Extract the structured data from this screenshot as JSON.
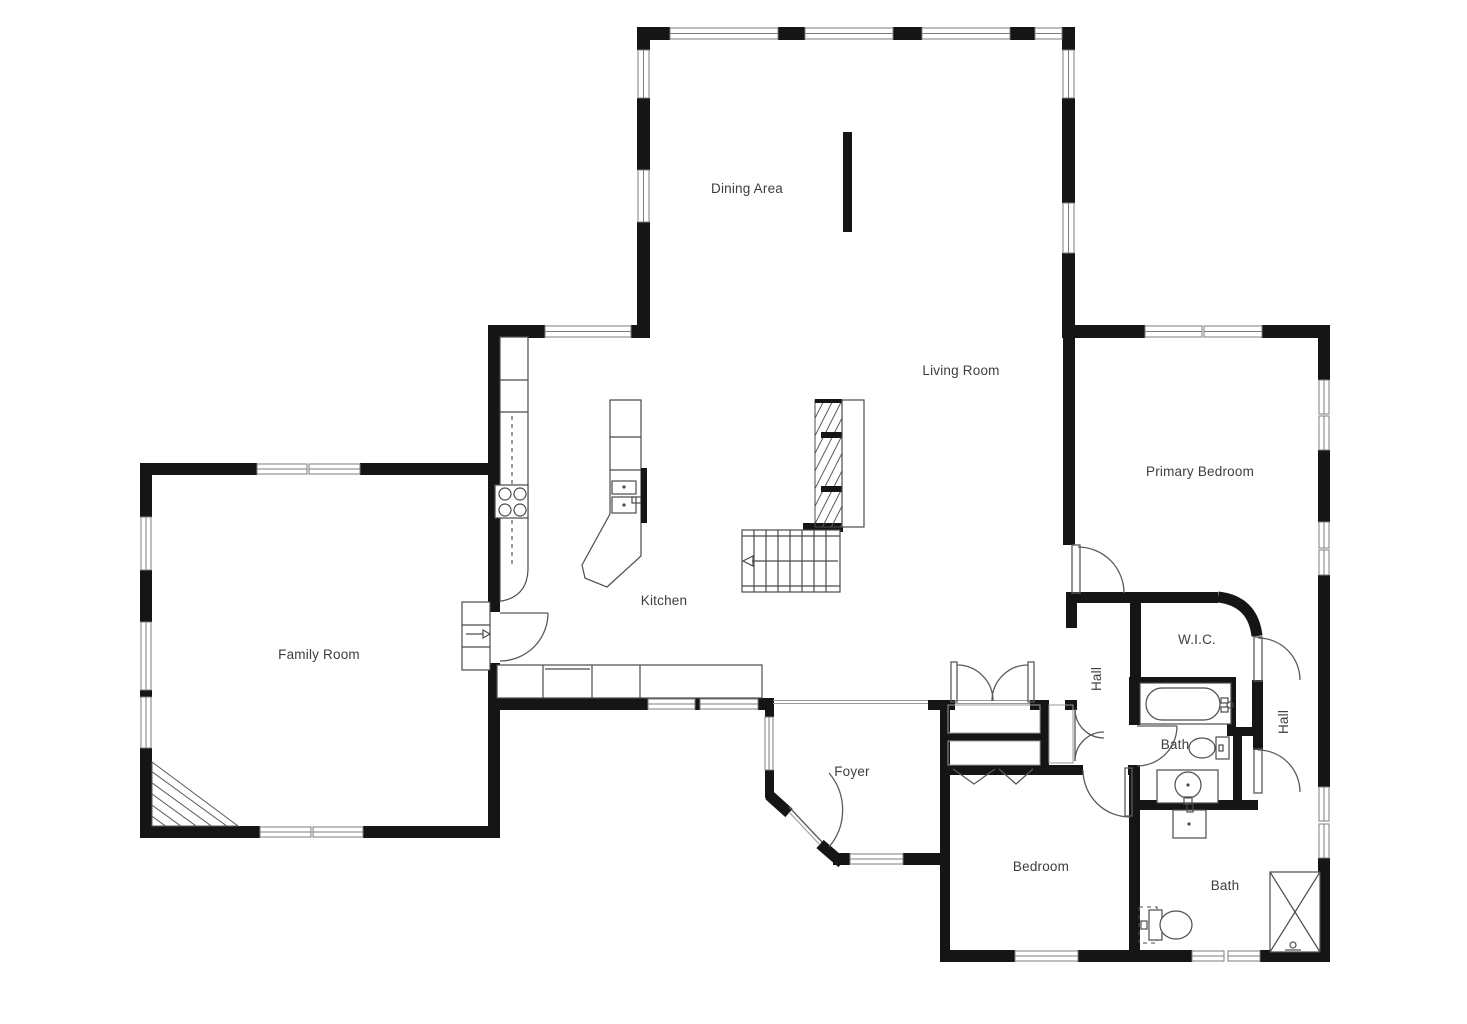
{
  "title": "Residential floor plan",
  "colors": {
    "background": "#ffffff",
    "walls": "#151515",
    "fixture_lines": "#4b4b4b",
    "window_frame": "#7d7d7d",
    "label_text": "#3d3d3d"
  },
  "rooms": {
    "dining_area": {
      "label": "Dining Area"
    },
    "living_room": {
      "label": "Living Room"
    },
    "primary_bedroom": {
      "label": "Primary Bedroom"
    },
    "family_room": {
      "label": "Family Room"
    },
    "kitchen": {
      "label": "Kitchen"
    },
    "foyer": {
      "label": "Foyer"
    },
    "hall_upper": {
      "label": "Hall"
    },
    "wic": {
      "label": "W.I.C."
    },
    "bath_main": {
      "label": "Bath"
    },
    "hall_east": {
      "label": "Hall"
    },
    "bedroom": {
      "label": "Bedroom"
    },
    "bath_second": {
      "label": "Bath"
    }
  },
  "fixtures": [
    "staircase-up-arrow",
    "stair-chimney-hatch",
    "kitchen-wall-counter",
    "cooktop-4-burners",
    "kitchen-island-with-sink",
    "base-cabinet-run",
    "dishwasher",
    "family-room-shelf-arrow",
    "corner-fireplace-hatch",
    "dining-partition-wall",
    "closet-double-doors",
    "closet-bifold-chevrons",
    "linen-closet-double-doors",
    "bathtub-with-faucet",
    "toilet-main-bath",
    "vanity-sink-main-bath",
    "vanity-sink-second-bath",
    "toilet-second-bath",
    "shower-stall-x",
    "entry-door-angled"
  ]
}
